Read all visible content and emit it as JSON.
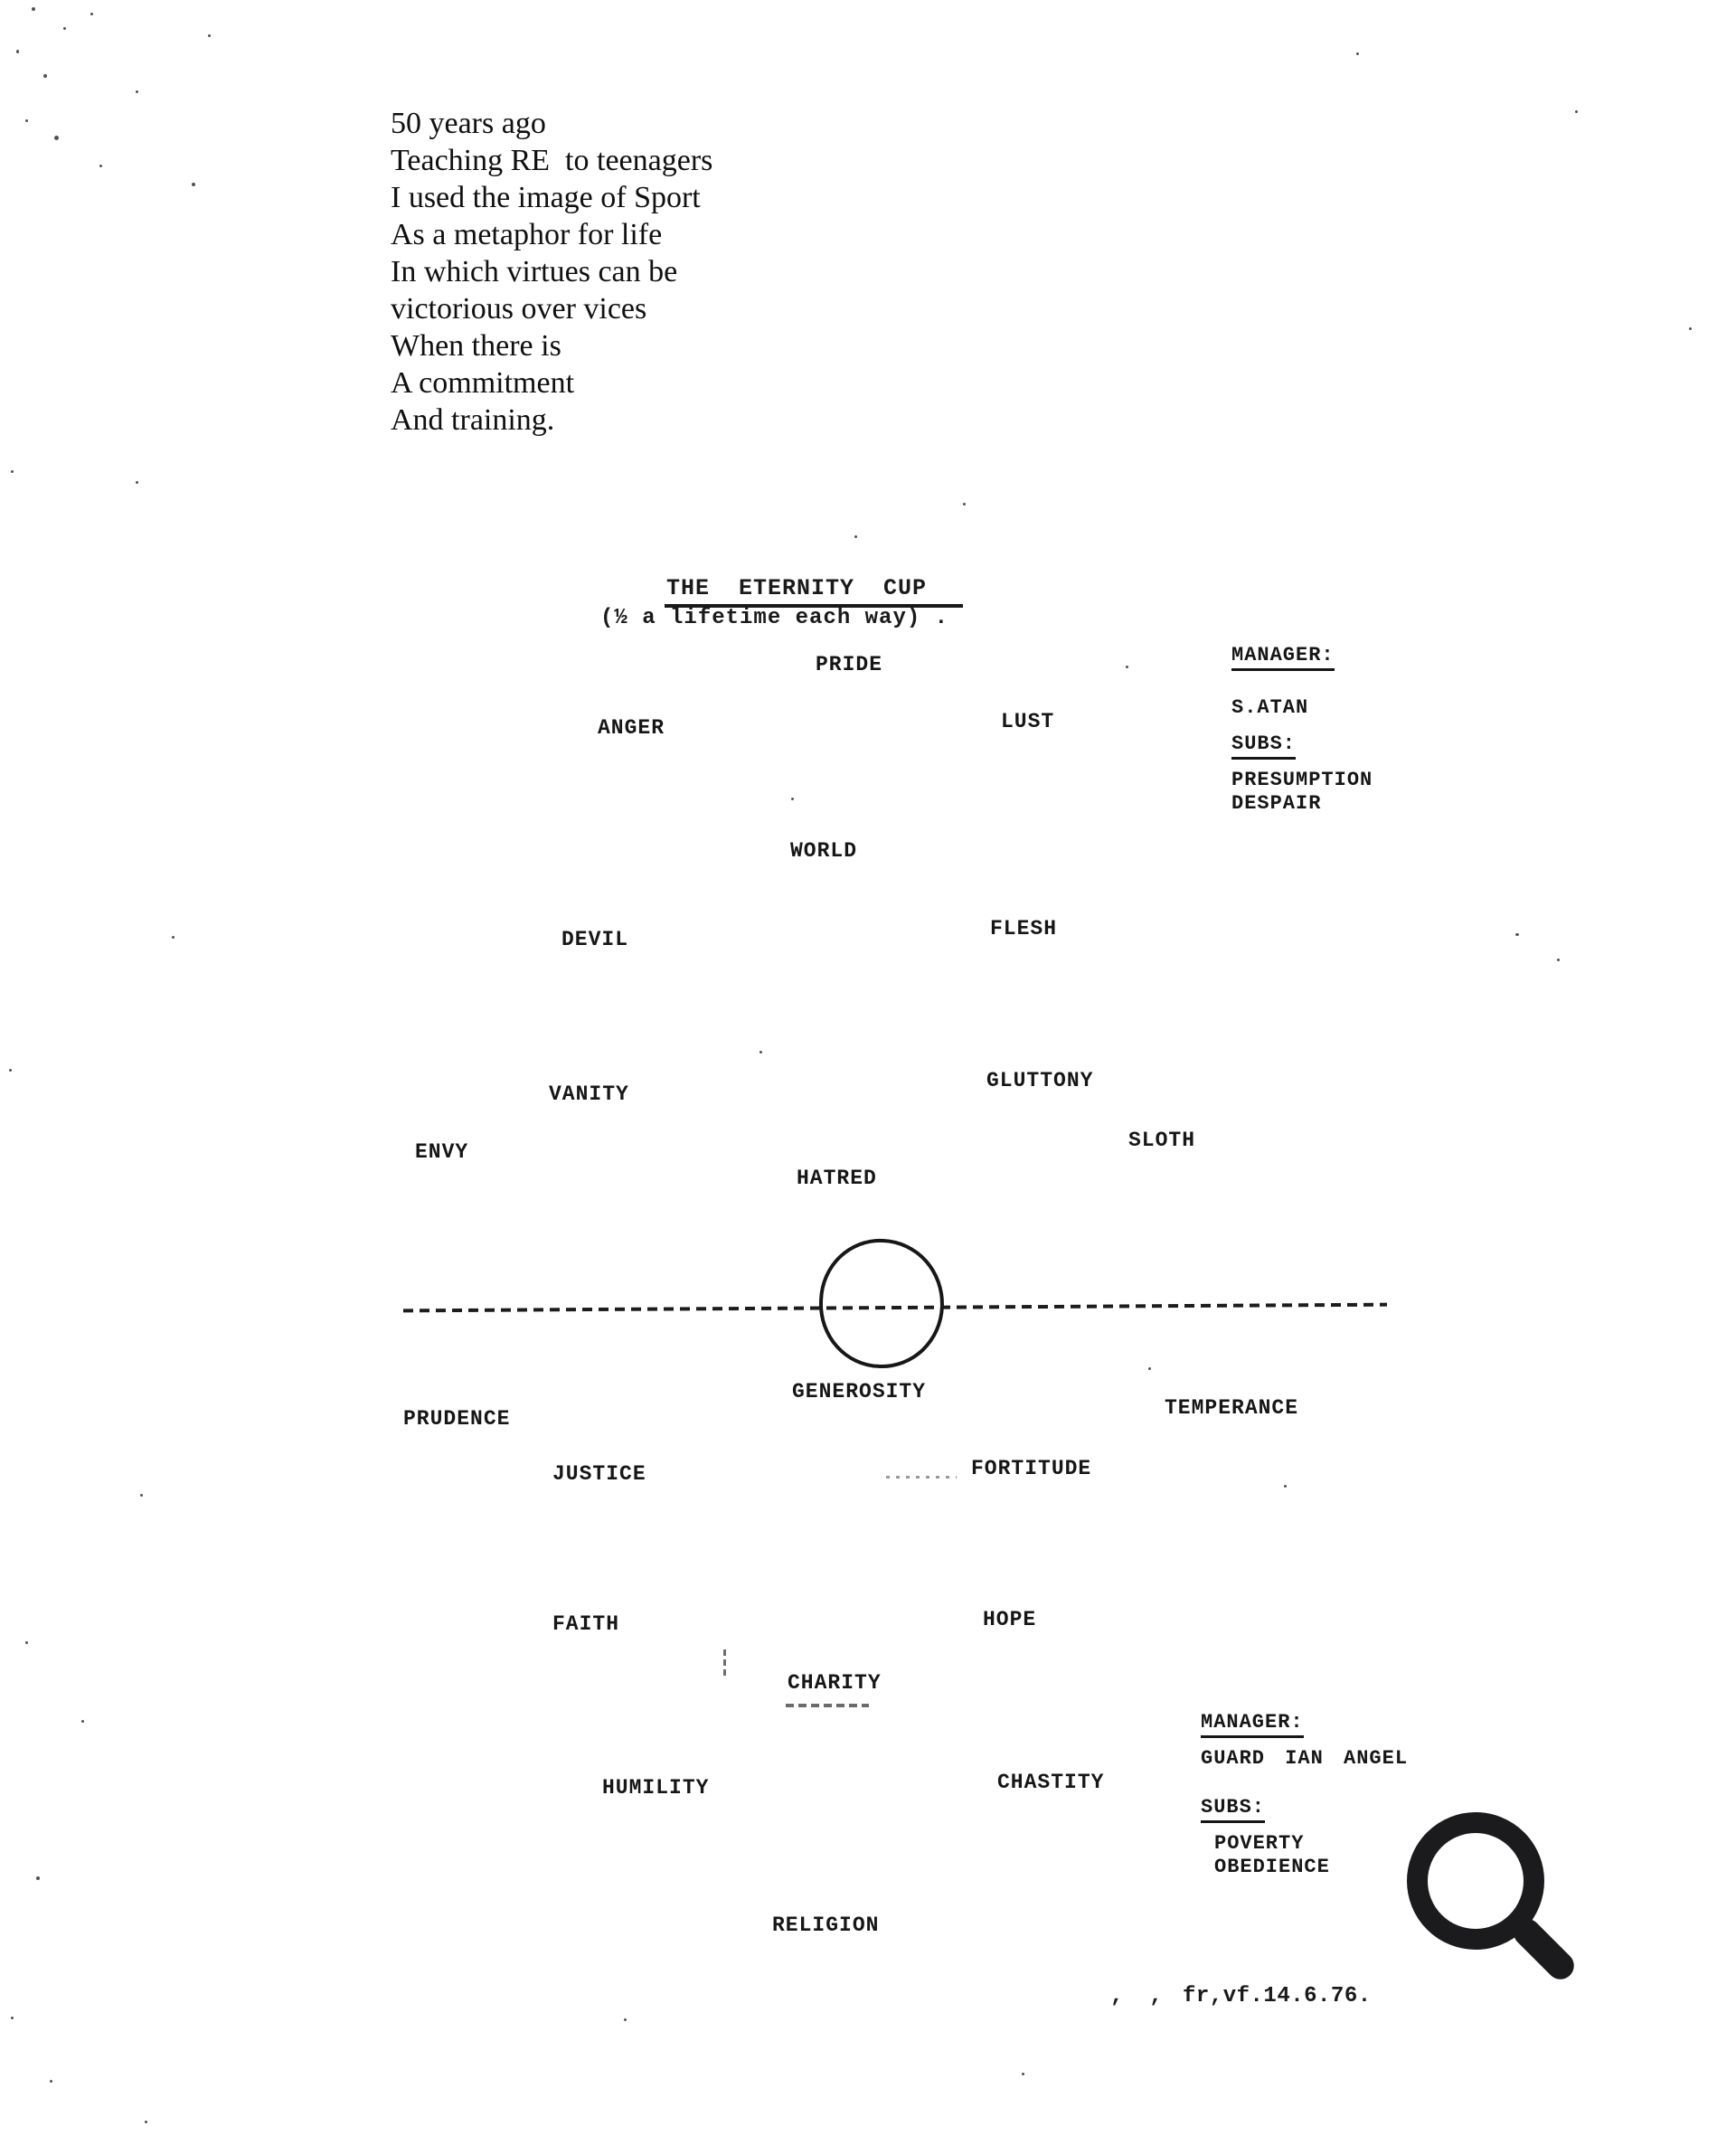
{
  "poem": {
    "lines": [
      "50 years ago",
      "Teaching RE  to teenagers",
      "I used the image of Sport",
      "As a metaphor for life",
      "In which virtues can be",
      "victorious over vices",
      "When there is",
      "A commitment",
      "And training."
    ]
  },
  "diagram": {
    "title": "THE  ETERNITY  CUP",
    "subtitle": "(½ a lifetime each way) .",
    "vices": {
      "pride": "PRIDE",
      "anger": "ANGER",
      "lust": "LUST",
      "world": "WORLD",
      "devil": "DEVIL",
      "flesh": "FLESH",
      "vanity": "VANITY",
      "gluttony": "GLUTTONY",
      "envy": "ENVY",
      "sloth": "SLOTH",
      "hatred": "HATRED"
    },
    "virtues": {
      "generosity": "GENEROSITY",
      "prudence": "PRUDENCE",
      "temperance": "TEMPERANCE",
      "justice": "JUSTICE",
      "fortitude": "FORTITUDE",
      "faith": "FAITH",
      "hope": "HOPE",
      "charity": "CHARITY",
      "humility": "HUMILITY",
      "chastity": "CHASTITY",
      "religion": "RELIGION"
    },
    "vices_manager": {
      "heading": "MANAGER:",
      "name": "S.ATAN",
      "subs_heading": "SUBS:",
      "subs": [
        "PRESUMPTION",
        "DESPAIR"
      ]
    },
    "virtues_manager": {
      "heading": "MANAGER:",
      "name": "GUARD IAN ANGEL",
      "subs_heading": "SUBS:",
      "subs": [
        "POVERTY",
        "OBEDIENCE"
      ]
    }
  },
  "footer": {
    "stray_marks": ",  ,",
    "reference": "fr,vf.14.6.76."
  },
  "icons": {
    "zoom": "magnifying-glass-icon"
  },
  "colors": {
    "ink": "#1a1a1a",
    "paper": "#ffffff",
    "icon": "#1b1b1d"
  }
}
